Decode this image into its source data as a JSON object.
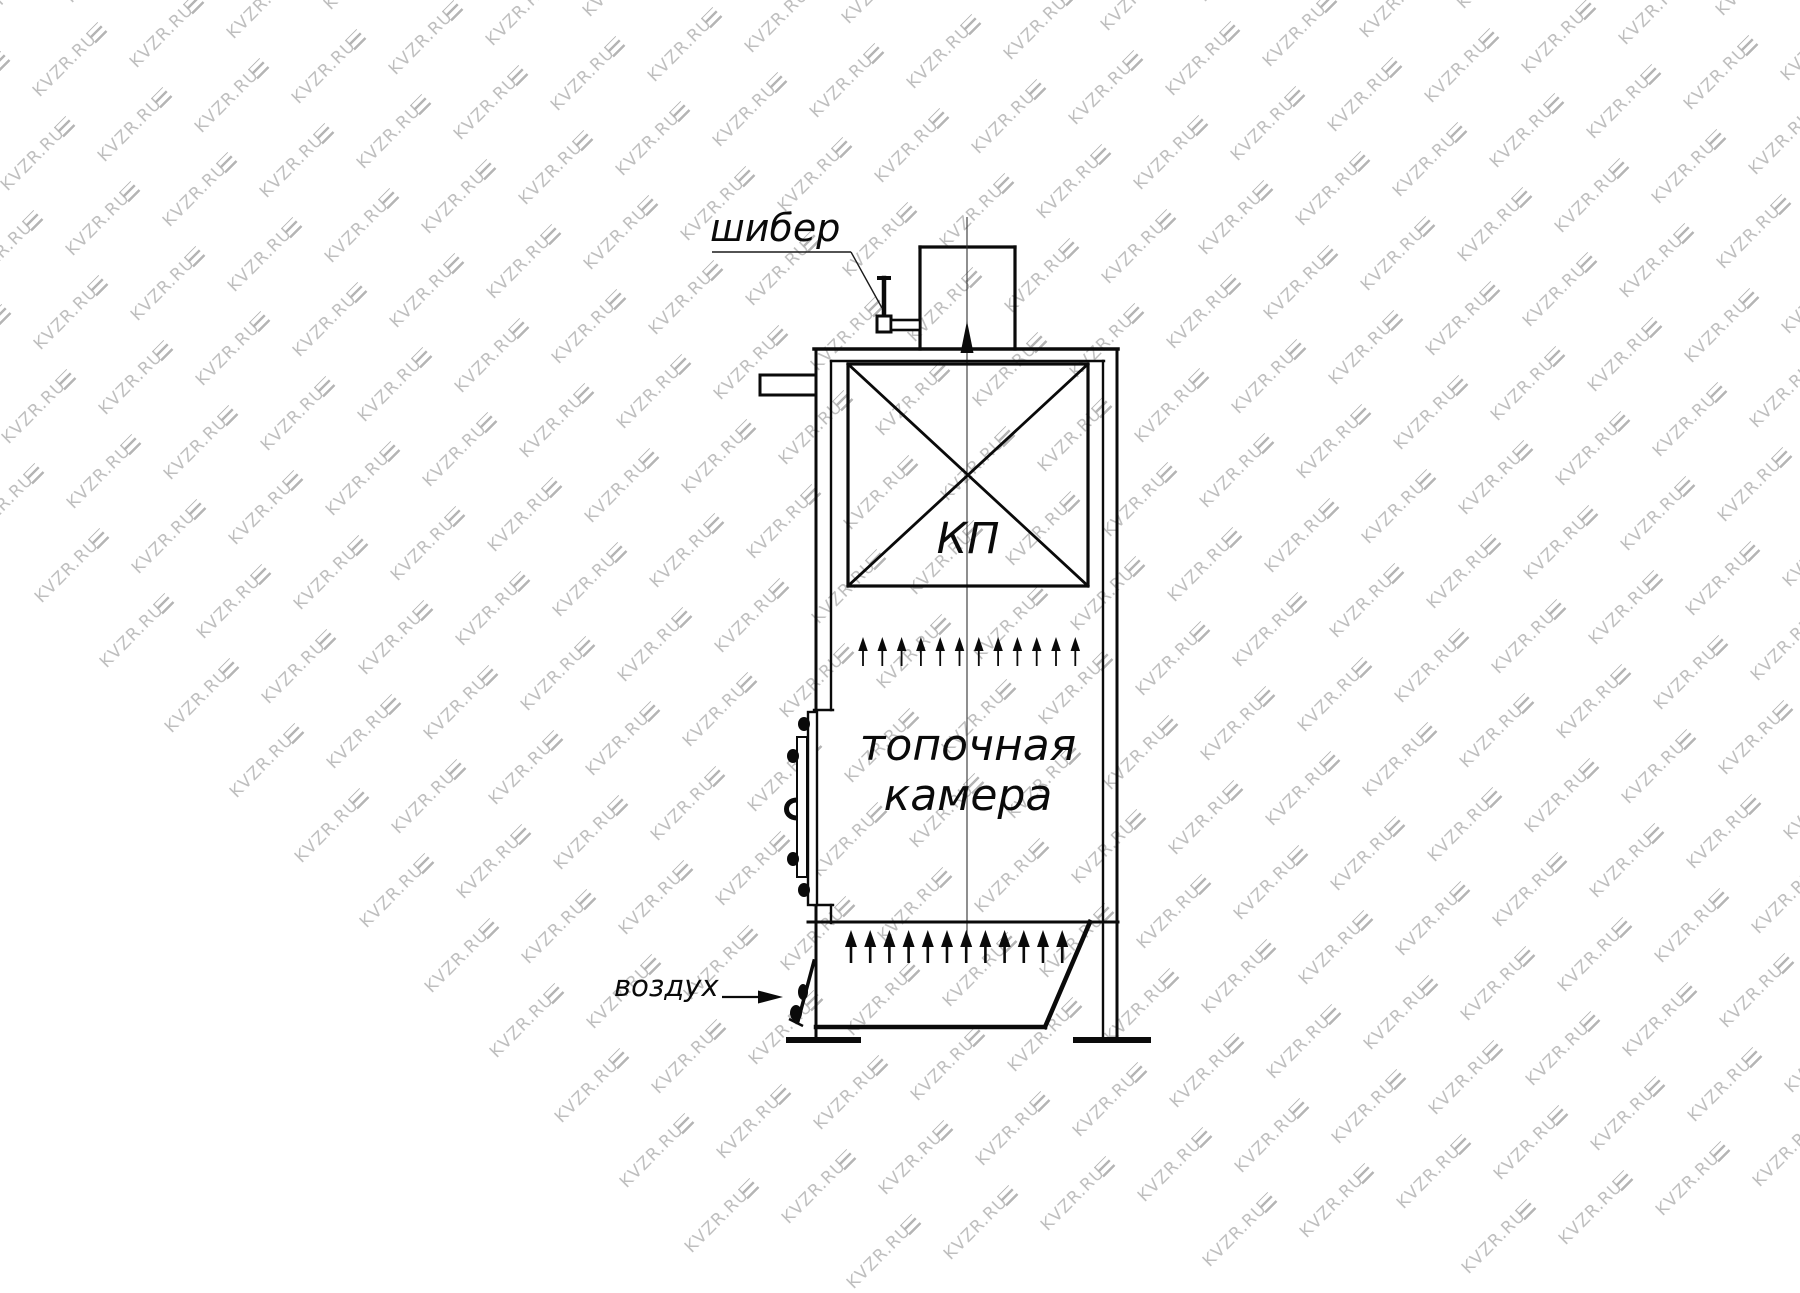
{
  "page": {
    "background": "#ffffff"
  },
  "watermark": {
    "text": "KVZR.RU",
    "text_color": "#bfbfbf",
    "logo_color": "#b5b5b5"
  },
  "drawing": {
    "line_color": "#0a0a0a",
    "labels": {
      "damper": "шибер",
      "heat_exchanger": "КП",
      "combustion_chamber": "топочная\nкамера",
      "air": "воздух"
    },
    "flow_arrows": {
      "upper_row_count": 12,
      "lower_row_count": 12
    }
  }
}
